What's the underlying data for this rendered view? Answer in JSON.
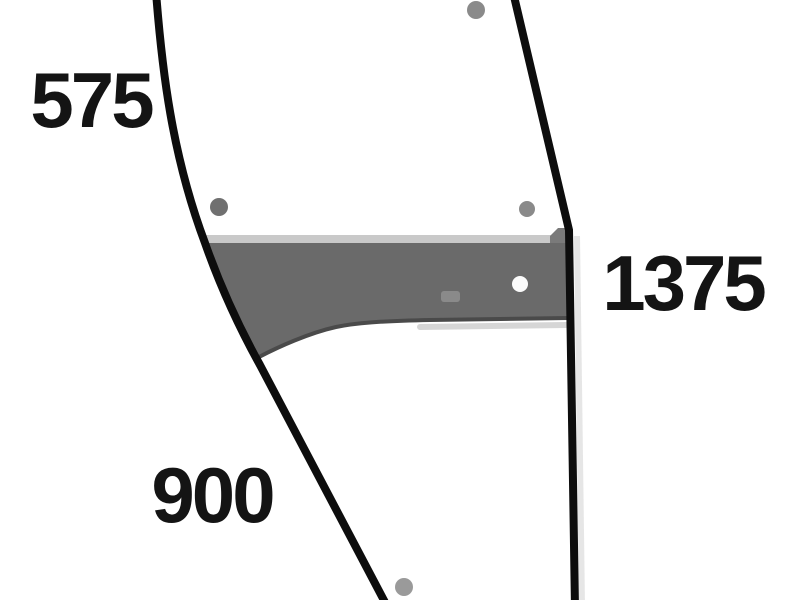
{
  "dimension_labels": {
    "left": "575",
    "right": "1375",
    "bottom": "900"
  },
  "colors": {
    "background": "#ffffff",
    "outline": "#0d0d0d",
    "band_fill": "#6a6a6a",
    "band_top_edge": "#c9c9c9",
    "band_bottom_edge": "#4a4a4a",
    "band_corner_step": "#7a7a7a",
    "band_marking": "#8e8e8e",
    "band_lower_highlight": "#cfcfcf",
    "edge_shadow": "#dcdcdc",
    "hole_gray": "#8a8a8a",
    "hole_dark": "#707070",
    "hole_light": "#9a9a9a",
    "hole_white": "#fbfbfb"
  }
}
